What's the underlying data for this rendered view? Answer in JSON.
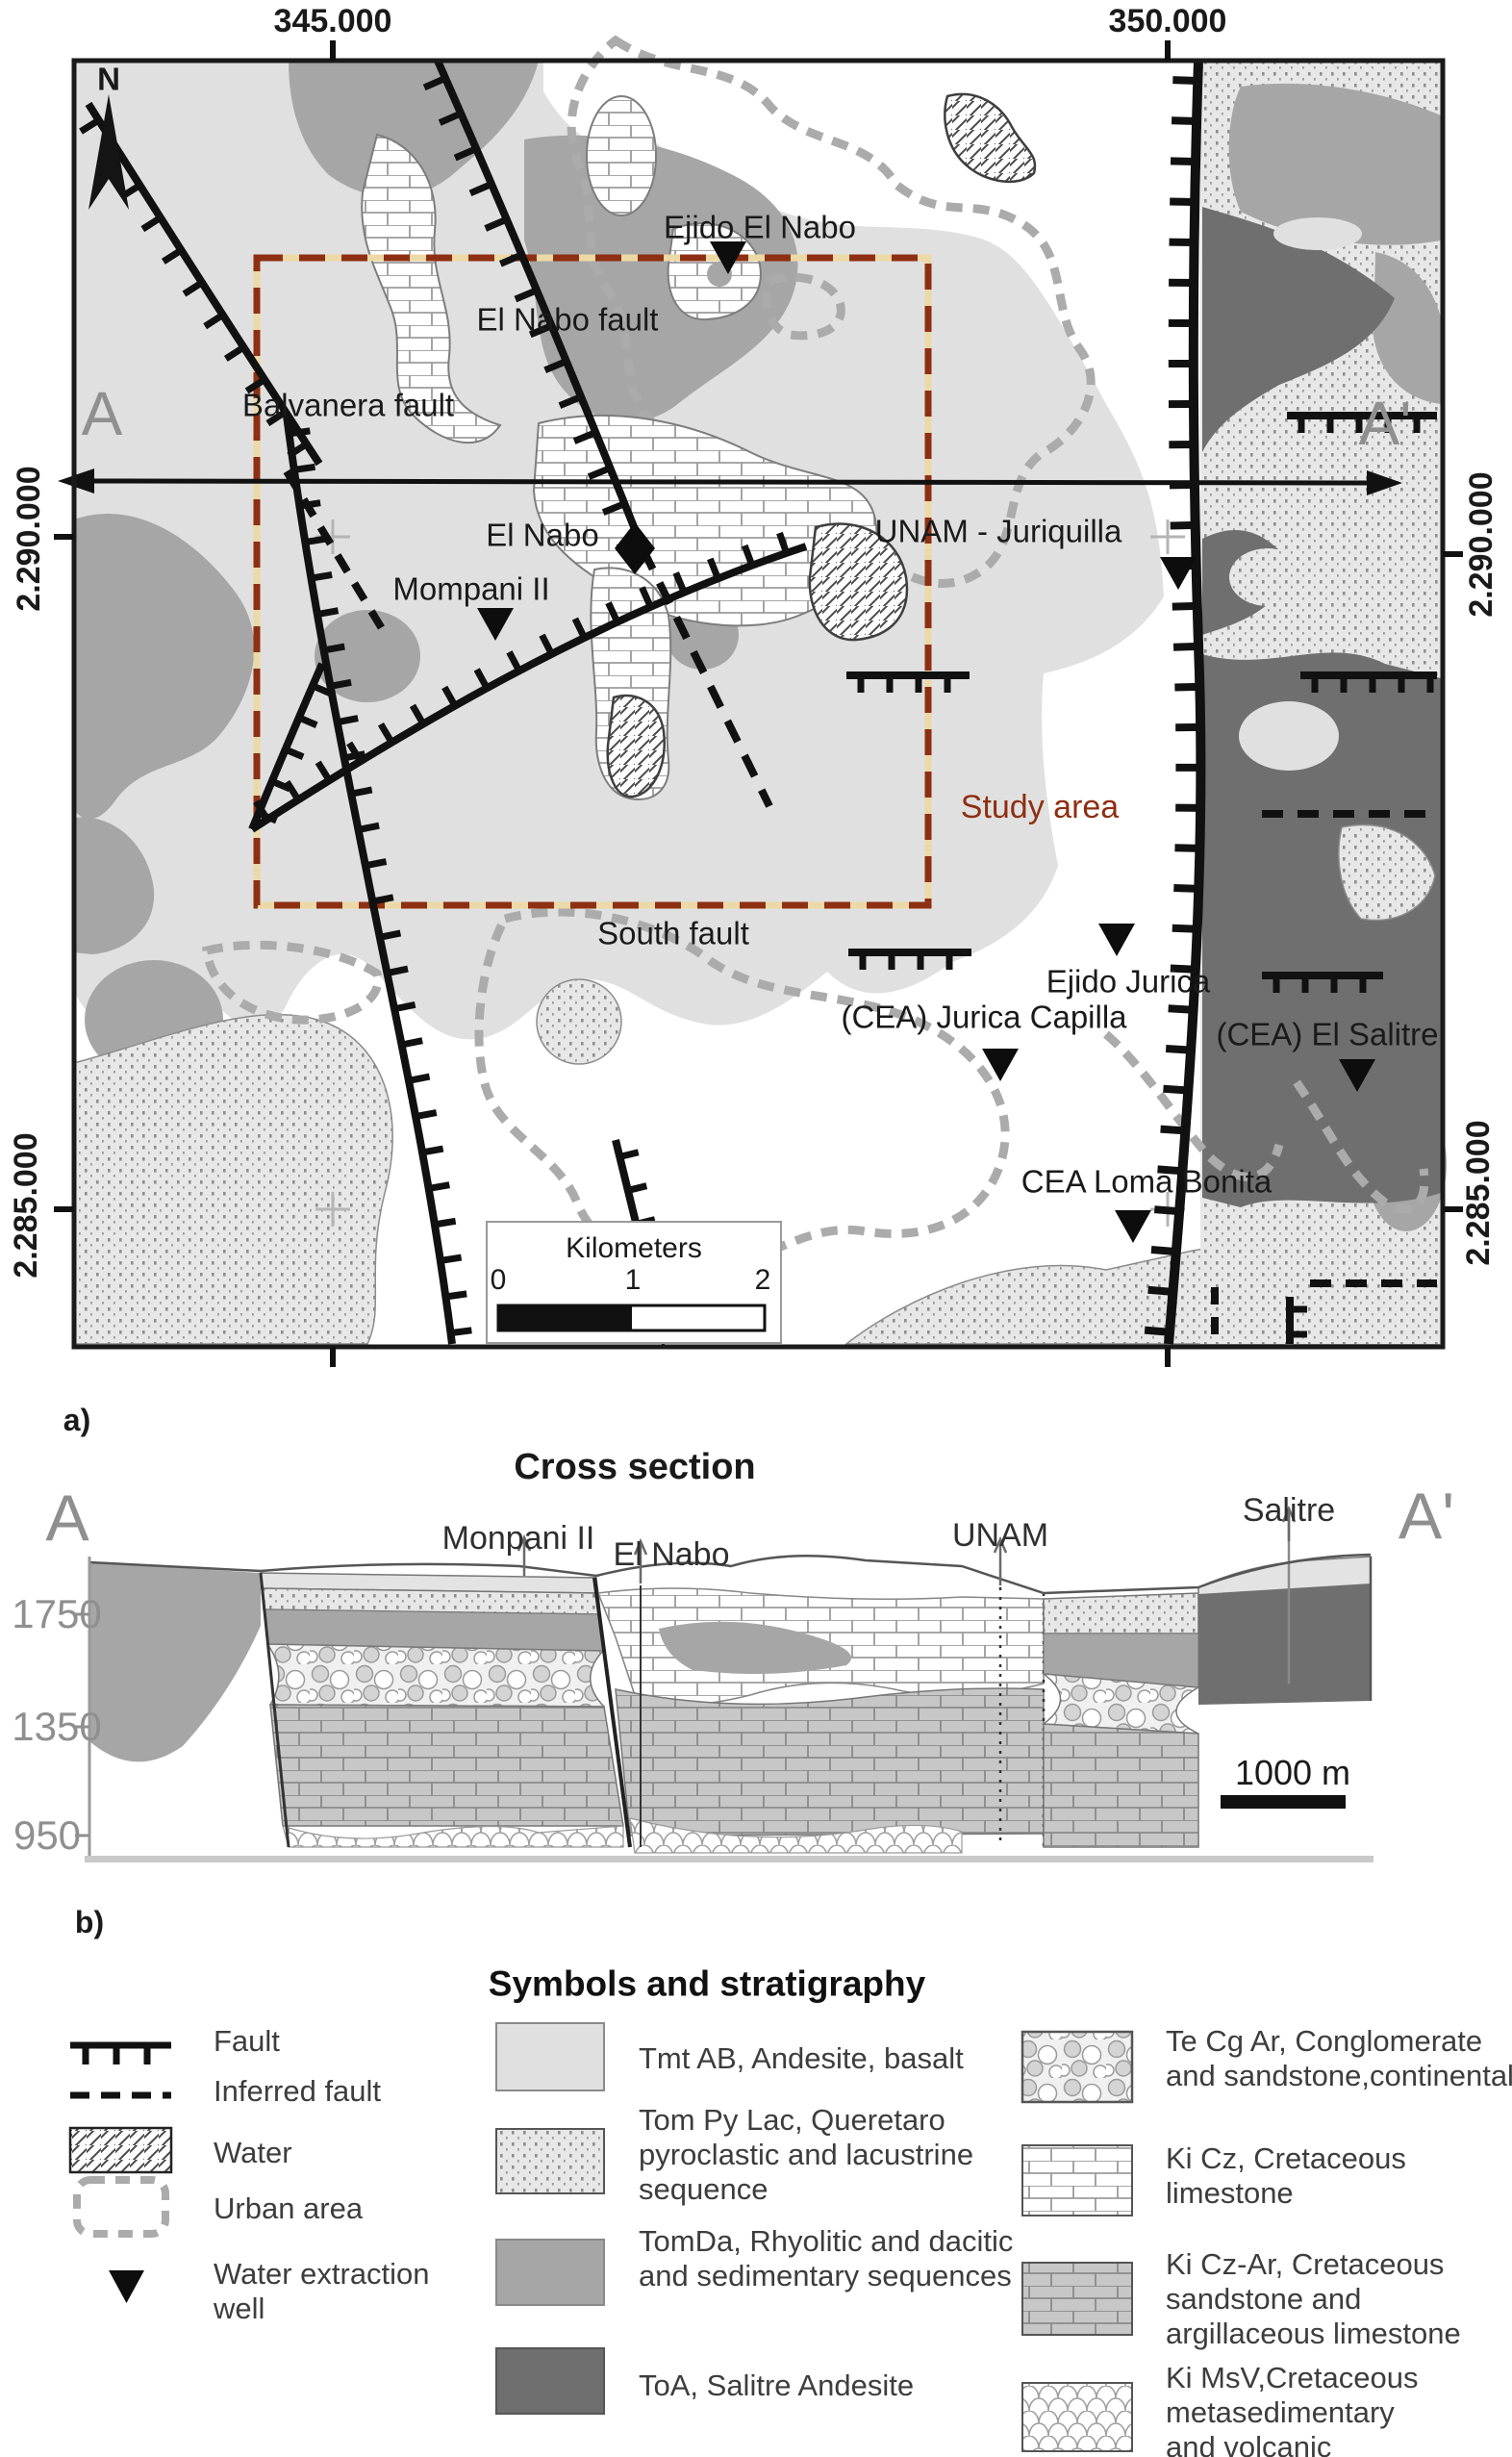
{
  "colors": {
    "study_area": "#8e2f12",
    "tmt_ab": "#e0e0e0",
    "tomda": "#a6a6a6",
    "toa": "#6f6f6f",
    "urban": "#ababab",
    "gray_label": "#8f8f8f"
  },
  "panel_a": {
    "label": "a)",
    "north": "N",
    "coords": {
      "e345": "345.000",
      "e350": "350.000",
      "n2290": "2.290.000",
      "n2285": "2.285.000"
    },
    "endpoints": {
      "a": "A",
      "a_prime": "A'"
    },
    "faults": {
      "balvanera": "Balvanera fault",
      "el_nabo": "El Nabo fault",
      "south": "South fault"
    },
    "study_area_label": "Study area",
    "places": {
      "ejido_el_nabo": "Ejido El Nabo",
      "el_nabo": "El Nabo",
      "mompani": "Mompani II",
      "unam": "UNAM - Juriquilla",
      "ejido_jurica": "Ejido Jurica",
      "jurica_capilla": "(CEA) Jurica Capilla",
      "el_salitre": "(CEA) El Salitre",
      "loma_bonita": "CEA Loma Bonita"
    },
    "scale_bar": {
      "title": "Kilometers",
      "t0": "0",
      "t1": "1",
      "t2": "2"
    }
  },
  "panel_b": {
    "label": "b)",
    "title": "Cross section",
    "endpoints": {
      "a": "A",
      "a_prime": "A'"
    },
    "wells": {
      "monpani": "Monpani II",
      "el_nabo": "El Nabo",
      "unam": "UNAM",
      "salitre": "Salitre"
    },
    "elevations": {
      "e1750": "1750",
      "e1350": "1350",
      "e950": "950"
    },
    "scale_label": "1000 m"
  },
  "legend": {
    "title": "Symbols and stratigraphy",
    "symbols": {
      "fault": "Fault",
      "inferred_fault": "Inferred fault",
      "water": "Water",
      "urban_area": "Urban area",
      "well": "Water extraction well"
    },
    "units": {
      "tmt_ab": "Tmt AB, Andesite, basalt",
      "tom_py_lac": "Tom Py Lac, Queretaro pyroclastic and lacustrine sequence",
      "tomda": "TomDa, Rhyolitic and dacitic and sedimentary sequences",
      "toa": "ToA, Salitre Andesite",
      "te_cg_ar": "Te Cg Ar, Conglomerate and sandstone,continental",
      "ki_cz": "Ki Cz, Cretaceous limestone",
      "ki_cz_ar": "Ki Cz-Ar, Cretaceous sandstone and argillaceous limestone",
      "ki_msv": "Ki MsV,Cretaceous metasedimentary and volcanic"
    }
  }
}
